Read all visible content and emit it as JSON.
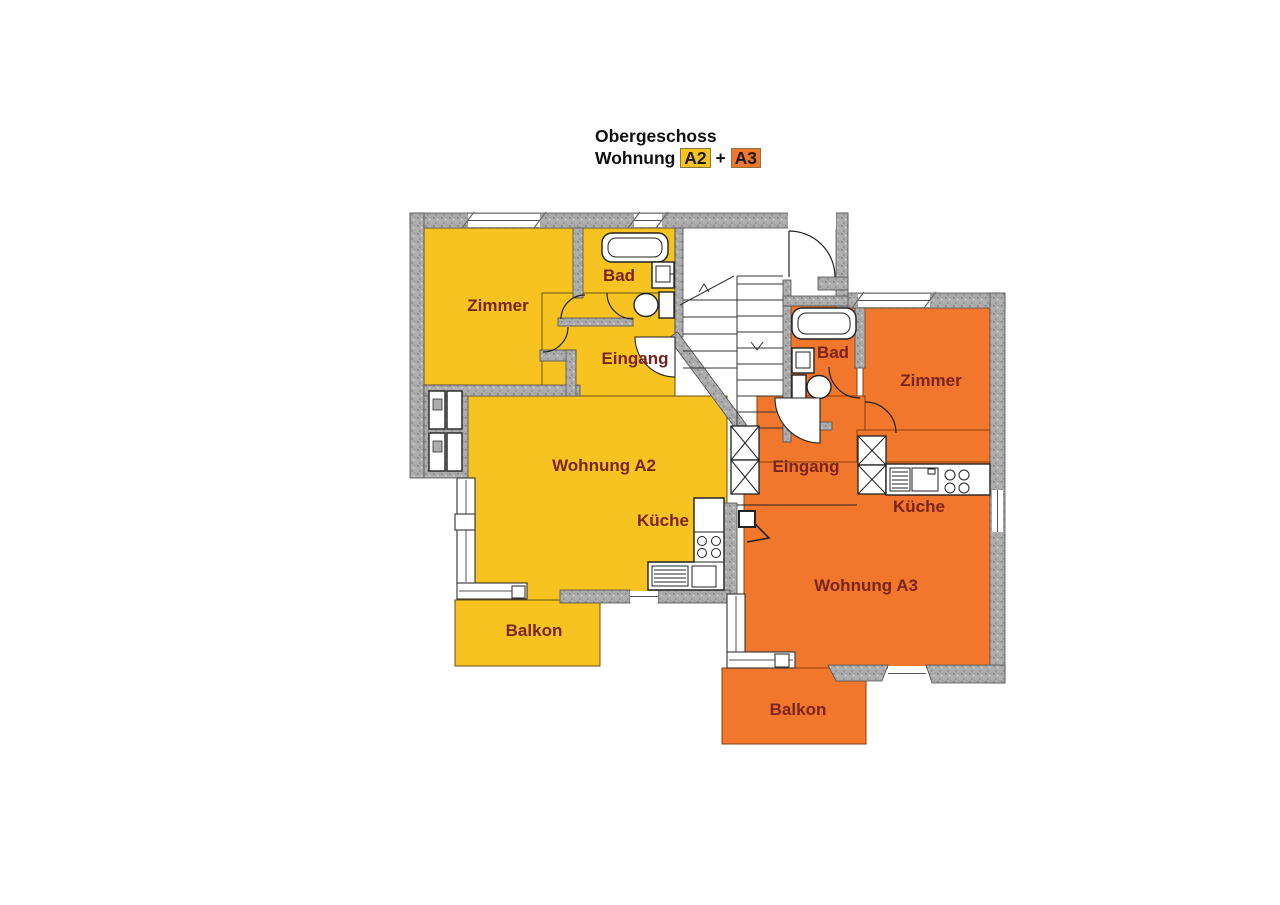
{
  "title": {
    "line1": "Obergeschoss",
    "line2_word": "Wohnung",
    "chip_a2": "A2",
    "plus": "+",
    "chip_a3": "A3"
  },
  "colors": {
    "a2_fill": "#F6C320",
    "a3_fill": "#F0772B",
    "wall_gray": "#ACACAC",
    "label_color": "#7B241C",
    "title_color": "#111111"
  },
  "apartments": {
    "a2": {
      "id": "A2",
      "rooms": {
        "zimmer": "Zimmer",
        "bad": "Bad",
        "eingang": "Eingang",
        "living": "Wohnung A2",
        "kueche": "Küche",
        "balkon": "Balkon"
      }
    },
    "a3": {
      "id": "A3",
      "rooms": {
        "bad": "Bad",
        "zimmer": "Zimmer",
        "eingang": "Eingang",
        "kueche": "Küche",
        "living": "Wohnung A3",
        "balkon": "Balkon"
      }
    }
  }
}
